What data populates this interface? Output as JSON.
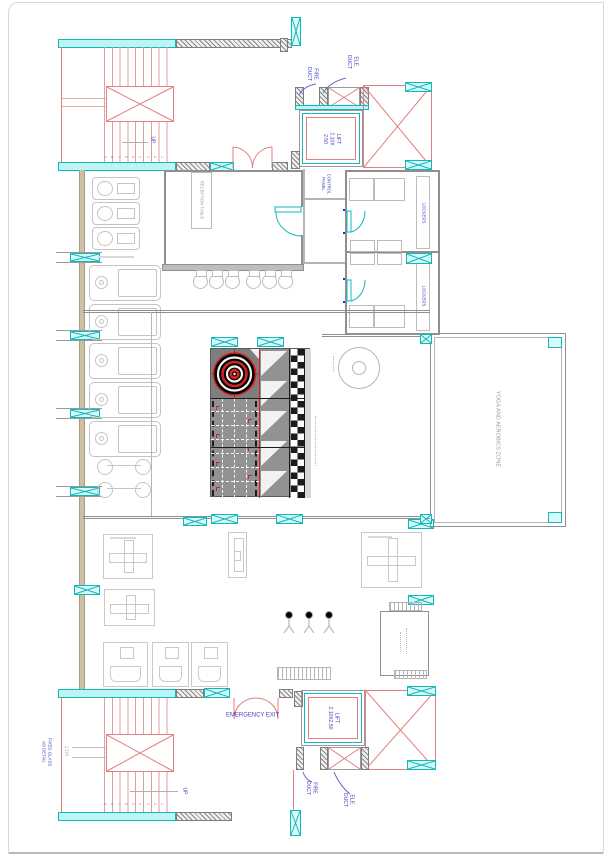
{
  "colors": {
    "cyan": "#12b8b8",
    "cyan_fill": "#bdf4f4",
    "cad_red": "#e08080",
    "bright_red": "#cc2020",
    "wall_gray": "#8f8f8f",
    "equip_gray": "#c4c4c4",
    "text_blue": "#4343bd",
    "text_gray": "#9a9a9a",
    "left_wall_tan": "#cdbfa4"
  },
  "stair_top": {
    "up": "UP",
    "numbers": [
      "1",
      "2",
      "3",
      "4",
      "5",
      "6",
      "7",
      "8",
      "9"
    ]
  },
  "stair_bottom": {
    "up": "UP",
    "numbers": [
      "1",
      "2",
      "3",
      "4",
      "5",
      "6",
      "7",
      "8",
      "9"
    ],
    "fixed_glass": [
      "FIXED GLASS",
      "AS DETAIL"
    ],
    "dim": "1.110"
  },
  "ducts_top": {
    "ele": [
      "ELE.",
      "DUCT"
    ],
    "fire": [
      "FIRE",
      "DUCT"
    ]
  },
  "ducts_bottom": {
    "ele": [
      "ELE.",
      "DUCT"
    ],
    "fire": [
      "FIRE",
      "DUCT"
    ]
  },
  "lift_top": [
    "LIFT",
    "2.10X",
    "2.50"
  ],
  "lift_bottom": [
    "LIFT",
    "2.10X2.50"
  ],
  "reception_table": "RECEPTION TABLE",
  "control_panel": [
    "CONTROL",
    "PANEL"
  ],
  "lockers_top": "LOCKERS",
  "lockers_bottom": "LOCKERS",
  "yoga_zone": "YOGA AND AEROBICS ZONE",
  "emergency_exit": "EMERGENCY EXIT"
}
